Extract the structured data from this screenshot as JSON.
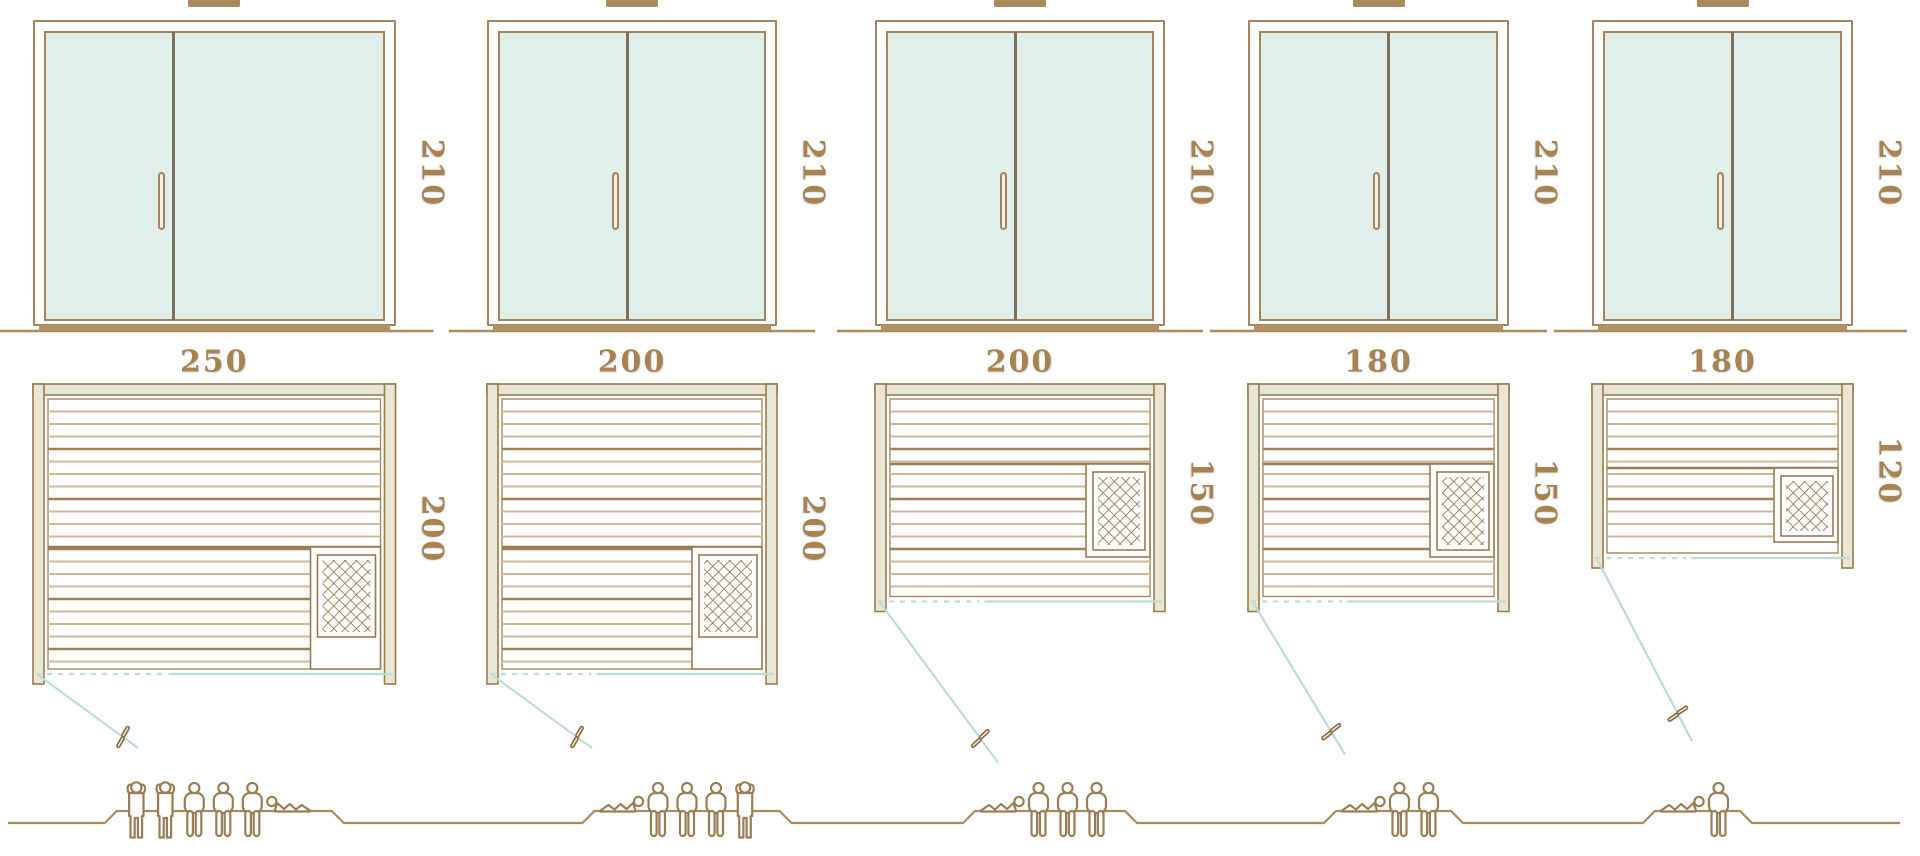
{
  "diagram": {
    "type": "sauna-size-comparison",
    "rows": [
      "front-elevation",
      "floor-plan",
      "capacity-figures"
    ],
    "scale_px_per_cm": 1.45
  },
  "colors": {
    "background": "#ffffff",
    "line_brown": "#9a7a50",
    "frame_brown": "#a5835c",
    "wall_fill": "#eae6d4",
    "glass": "#e1efeb",
    "door_divider": "#7e6f60",
    "handle_fill": "#f6efe3",
    "slat_dark": "#a27f55",
    "slat_light": "#cdb898",
    "swing_teal": "#bcdcd6",
    "label_text": "#a8824f",
    "ground": "#a98a5e",
    "figure": "#9b7d55",
    "sill": "#b19164"
  },
  "saunas": [
    {
      "x": 33,
      "width_cm": 250,
      "depth_cm": 200,
      "height_cm": 210,
      "height_label": "210",
      "width_label": "250",
      "depth_label": "200",
      "capacity": 6,
      "people": [
        "standing",
        "standing",
        "sitting",
        "sitting",
        "sitting",
        "lying-left"
      ],
      "heater": {
        "anchor": "front",
        "notch_h": 122,
        "notch_w": 70,
        "tray_h": 82
      },
      "swing": {
        "dx": 100,
        "dy": 73
      },
      "platform_offset": 10,
      "platform_w": 215
    },
    {
      "x": 487,
      "width_cm": 200,
      "depth_cm": 200,
      "height_cm": 210,
      "height_label": "210",
      "width_label": "200",
      "depth_label": "200",
      "capacity": 5,
      "people": [
        "lying",
        "sitting",
        "sitting",
        "sitting",
        "standing"
      ],
      "heater": {
        "anchor": "front",
        "notch_h": 122,
        "notch_w": 70,
        "tray_h": 82
      },
      "swing": {
        "dx": 100,
        "dy": 73
      },
      "platform_offset": 55,
      "platform_w": 185
    },
    {
      "x": 875,
      "width_cm": 200,
      "depth_cm": 150,
      "height_cm": 210,
      "height_label": "210",
      "width_label": "200",
      "depth_label": "150",
      "capacity": 4,
      "people": [
        "lying",
        "sitting",
        "sitting",
        "sitting"
      ],
      "heater": {
        "anchor": "mid",
        "notch_top": 80,
        "notch_h": 93,
        "notch_w": 64,
        "tray_h": 78
      },
      "swing": {
        "dx": 118,
        "dy": 160
      },
      "platform_offset": 30,
      "platform_w": 150
    },
    {
      "x": 1248,
      "width_cm": 180,
      "depth_cm": 150,
      "height_cm": 210,
      "height_label": "210",
      "width_label": "180",
      "depth_label": "150",
      "capacity": 3,
      "people": [
        "lying",
        "sitting",
        "sitting"
      ],
      "heater": {
        "anchor": "mid",
        "notch_top": 80,
        "notch_h": 93,
        "notch_w": 64,
        "tray_h": 78
      },
      "swing": {
        "dx": 92,
        "dy": 152
      },
      "platform_offset": 15,
      "platform_w": 115
    },
    {
      "x": 1592,
      "width_cm": 180,
      "depth_cm": 120,
      "height_cm": 210,
      "height_label": "210",
      "width_label": "180",
      "depth_label": "120",
      "capacity": 2,
      "people": [
        "lying",
        "sitting"
      ],
      "heater": {
        "anchor": "mid",
        "notch_top": 84,
        "notch_h": 74,
        "notch_w": 64,
        "tray_h": 60
      },
      "swing": {
        "dx": 95,
        "dy": 182
      },
      "platform_offset": -25,
      "platform_w": 85
    }
  ],
  "layout": {
    "door_top": 20,
    "door_h": 306,
    "ground_y": 331,
    "plan_top": 384,
    "wall_t": 11,
    "people_baseline": 823,
    "platform_top": 811
  }
}
